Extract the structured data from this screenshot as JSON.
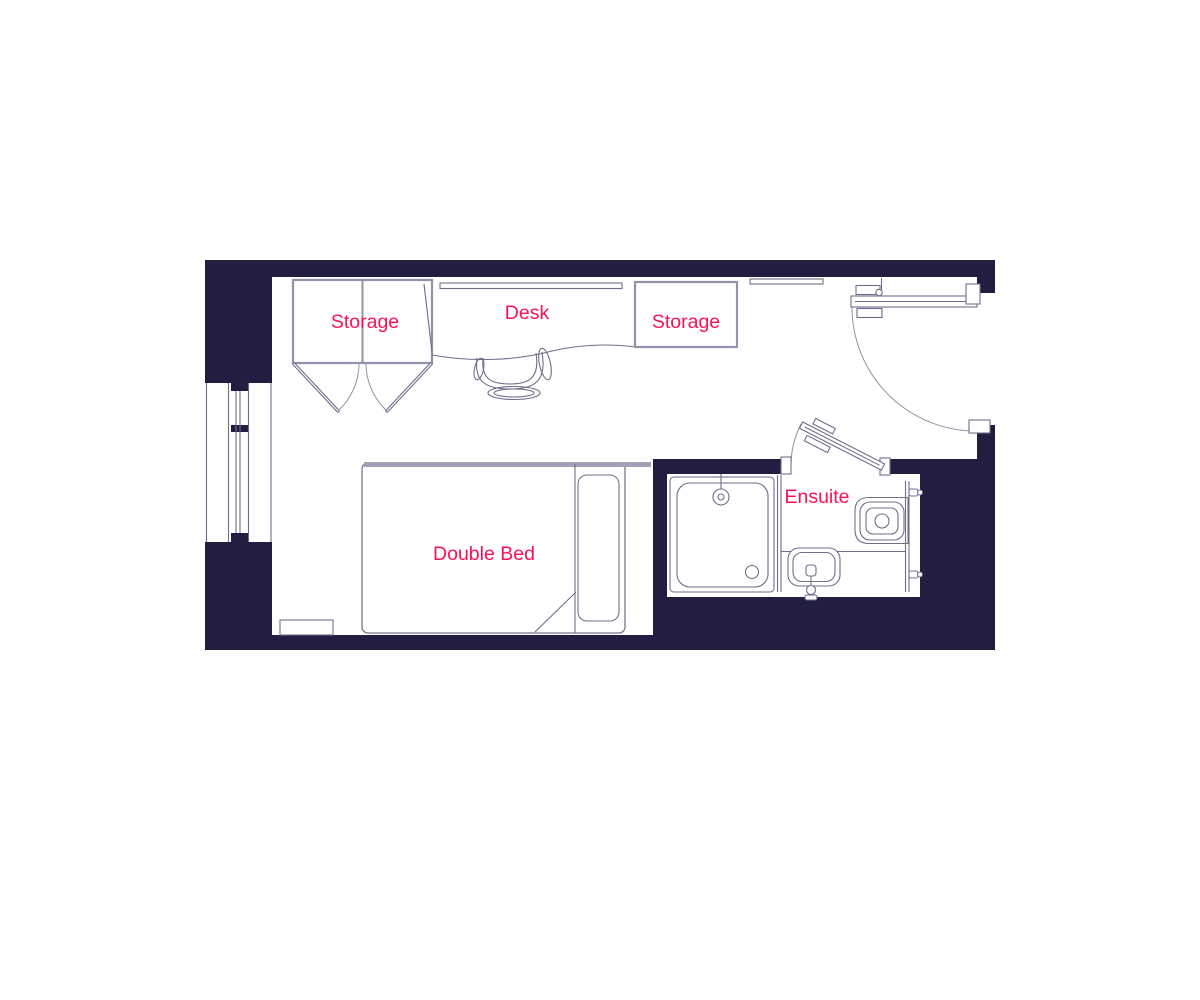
{
  "colors": {
    "wall": "#211e41",
    "outline": "#9094aa",
    "detail": "#6e6e8c",
    "arc": "#9191a7",
    "label": "#fa1158",
    "floor": "#ffffff"
  },
  "labels": {
    "storage_left": "Storage",
    "desk": "Desk",
    "storage_right": "Storage",
    "double_bed": "Double Bed",
    "ensuite": "Ensuite"
  }
}
